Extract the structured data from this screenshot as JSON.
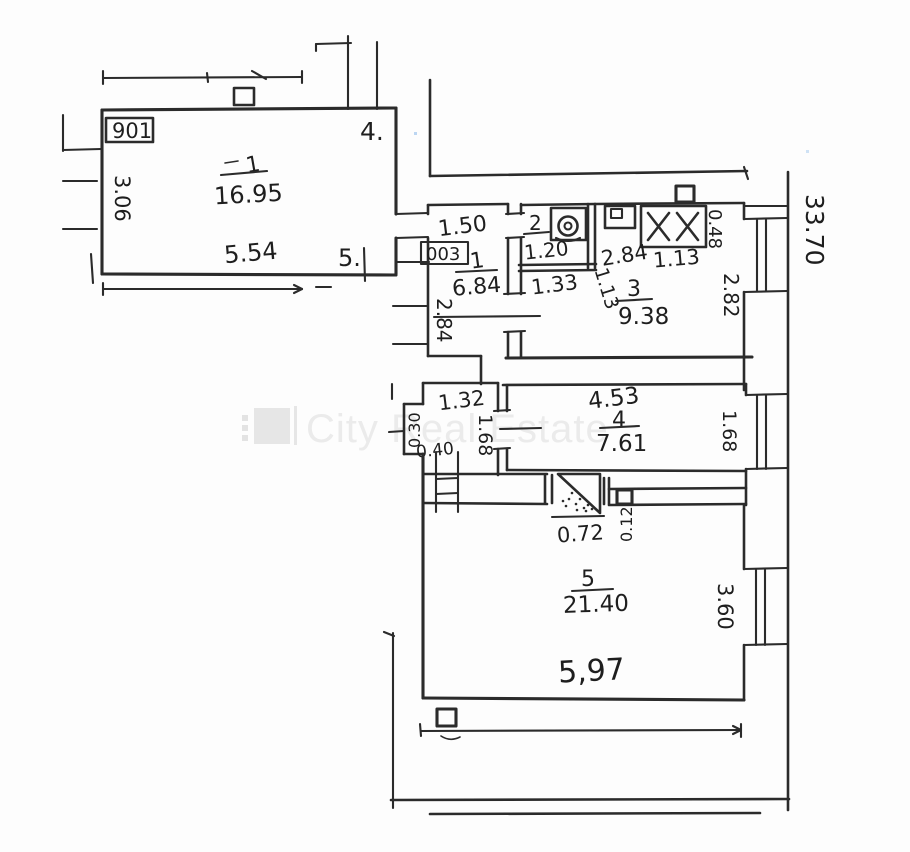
{
  "watermark": {
    "brand": "City Real Estate"
  },
  "plan": {
    "apartment_number": "901",
    "unit_number": "003",
    "building_length": "33.70",
    "living_room": {
      "number": "1",
      "area": "16.95",
      "width": "5.54",
      "depth": "3.06",
      "door_mark_top": "4.",
      "door_mark_bottom": "5."
    },
    "hallway": {
      "door_width": "1.50",
      "number": "1",
      "area": "6.84",
      "depth": "2.84"
    },
    "wc": {
      "number": "2",
      "area": "1.20",
      "width": "1.33"
    },
    "kitchen": {
      "number": "3",
      "area": "9.38",
      "dim_a": "2.84",
      "dim_b": "1.13",
      "stove_width": "1.13",
      "stove_depth": "0.48",
      "depth": "2.82"
    },
    "closet": {
      "width": "1.32",
      "niche_depth": "0.30",
      "niche_width": "0.40",
      "depth": "1.68"
    },
    "room4": {
      "number": "4",
      "area": "7.61",
      "width": "4.53",
      "depth": "1.68"
    },
    "entry": {
      "stair_width": "0.72",
      "ledge": "0.12"
    },
    "room5": {
      "number": "5",
      "area": "21.40",
      "width": "5,97",
      "depth": "3.60"
    }
  }
}
